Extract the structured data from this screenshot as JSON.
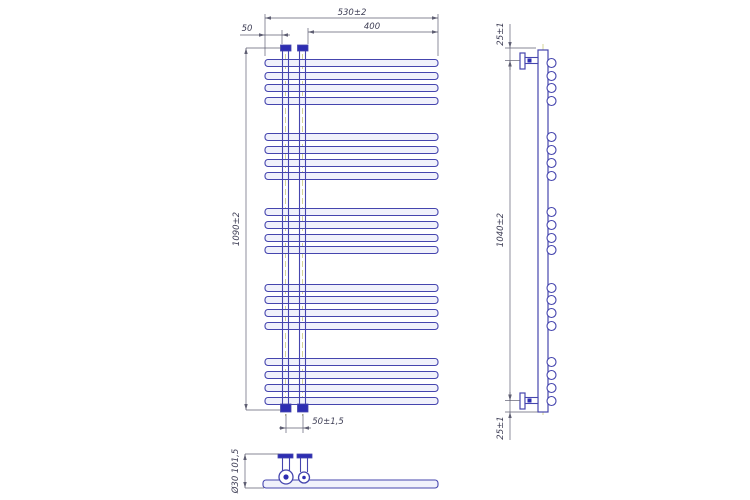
{
  "meta": {
    "description": "CAD three-view technical drawing of a designer towel-rail radiator (front view, side view, bottom view) with dimension callouts",
    "canvas": {
      "w": 750,
      "h": 500
    }
  },
  "colors": {
    "line": "#4545ae",
    "fill_dark": "#2d2db2",
    "tube_fill": "#f0f1fb",
    "white": "#ffffff",
    "centerline": "#c2c26e",
    "dim_line": "#5f5f73",
    "dim_text": "#3e3e55",
    "bg": "#ffffff"
  },
  "front_view": {
    "tube_x1": 265,
    "tube_x2": 438,
    "tube_h": 7,
    "tube_rx": 3,
    "tube_centers_y": [
      63,
      76,
      88,
      101,
      137,
      150,
      163,
      176,
      212,
      225,
      238,
      250,
      288,
      300,
      313,
      326,
      362,
      375,
      388,
      401
    ],
    "riser_lines_x": [
      282.5,
      288.5,
      299.5,
      305.5
    ],
    "riser_centerlines_x": [
      285.5,
      302.5
    ],
    "riser_y1": 51,
    "riser_y2": 404,
    "caps": [
      {
        "x": 280.5,
        "y": 45,
        "w": 10.5,
        "h": 6
      },
      {
        "x": 297.5,
        "y": 45,
        "w": 10.5,
        "h": 6
      }
    ],
    "fittings": [
      {
        "x": 280.5,
        "y": 404,
        "w": 10.5,
        "h": 8
      },
      {
        "x": 297.5,
        "y": 404,
        "w": 10.5,
        "h": 8
      }
    ]
  },
  "side_view": {
    "collector": {
      "x": 538,
      "y": 50,
      "w": 10,
      "h": 362
    },
    "centerline_x": 543,
    "centerline_y1": 44,
    "centerline_y2": 418,
    "circle_cx": 551.5,
    "circle_r": 4.5,
    "circle_centers_y": [
      63,
      76,
      88,
      101,
      137,
      150,
      163,
      176,
      212,
      225,
      238,
      250,
      288,
      300,
      313,
      326,
      362,
      375,
      388,
      401
    ],
    "brackets": [
      {
        "flange": {
          "x": 520,
          "y": 53,
          "w": 5,
          "h": 16
        },
        "arm": {
          "x": 525,
          "y": 57.5,
          "w": 13,
          "h": 6
        },
        "screw": {
          "x": 527.5,
          "y": 58.5,
          "w": 4,
          "h": 4
        }
      },
      {
        "flange": {
          "x": 520,
          "y": 393,
          "w": 5,
          "h": 16
        },
        "arm": {
          "x": 525,
          "y": 397.5,
          "w": 13,
          "h": 6
        },
        "screw": {
          "x": 527.5,
          "y": 398.5,
          "w": 4,
          "h": 4
        }
      }
    ]
  },
  "bottom_view": {
    "tube": {
      "x": 263,
      "y": 480,
      "w": 175,
      "h": 8,
      "rx": 3
    },
    "flanges": [
      {
        "x": 278,
        "y": 454,
        "w": 15,
        "h": 4
      },
      {
        "x": 297,
        "y": 454,
        "w": 15,
        "h": 4
      }
    ],
    "pipes": [
      {
        "x1": 282.5,
        "x2": 289.5,
        "y1": 458,
        "y2": 472
      },
      {
        "x1": 300.5,
        "x2": 307.5,
        "y1": 458,
        "y2": 472
      }
    ],
    "circles": [
      {
        "cx": 286,
        "cy": 477,
        "r": 7,
        "dot": 2.6
      },
      {
        "cx": 304,
        "cy": 477.5,
        "r": 5.5,
        "dot": 1.8
      }
    ]
  },
  "dimensions": [
    {
      "id": "width-total",
      "type": "h",
      "y": 18,
      "x1": 265,
      "x2": 438,
      "label": "530±2",
      "lx": 352,
      "ly": 15,
      "arrows": "in",
      "ext": [
        [
          265,
          14,
          265,
          56
        ],
        [
          438,
          14,
          438,
          56
        ]
      ]
    },
    {
      "id": "width-400",
      "type": "h",
      "y": 32,
      "x1": 308,
      "x2": 438,
      "label": "400",
      "lx": 372,
      "ly": 29,
      "arrows": "in",
      "ext": [
        [
          308,
          28,
          308,
          44
        ]
      ]
    },
    {
      "id": "offset-50",
      "type": "h",
      "y": 35,
      "x1": 265,
      "x2": 282,
      "label": "50",
      "lx": 247,
      "ly": 31,
      "arrows": "out",
      "line": [
        240,
        35,
        290,
        35
      ],
      "ext": [
        [
          282,
          30,
          282,
          44
        ]
      ]
    },
    {
      "id": "height-total",
      "type": "v",
      "x": 246,
      "y1": 48,
      "y2": 410,
      "label": "1090±2",
      "lx": 239,
      "ly": 229,
      "arrows": "in",
      "ext": [
        [
          246,
          48,
          281,
          48
        ],
        [
          246,
          410,
          281,
          410
        ]
      ]
    },
    {
      "id": "conn-spacing",
      "type": "h",
      "y": 428,
      "x1": 286,
      "x2": 303,
      "label": "50±1,5",
      "lx": 328,
      "ly": 424,
      "arrows": "out",
      "line": [
        279,
        428,
        311,
        428
      ],
      "ext": [
        [
          286,
          414,
          286,
          433
        ],
        [
          303,
          414,
          303,
          433
        ]
      ]
    },
    {
      "id": "side-top-offset",
      "type": "v",
      "x": 510,
      "y1": 48,
      "y2": 60.5,
      "label": "25±1",
      "lx": 503,
      "ly": 34,
      "arrows": "out",
      "line": [
        510,
        24,
        510,
        70
      ],
      "ext": [
        [
          505,
          48,
          536,
          48
        ],
        [
          505,
          60.5,
          520,
          60.5
        ]
      ]
    },
    {
      "id": "side-axis-height",
      "type": "v",
      "x": 510,
      "y1": 60.5,
      "y2": 400.5,
      "label": "1040±2",
      "lx": 503,
      "ly": 230,
      "arrows": "in"
    },
    {
      "id": "side-bottom-offset",
      "type": "v",
      "x": 510,
      "y1": 400.5,
      "y2": 412,
      "label": "25±1",
      "lx": 503,
      "ly": 428,
      "arrows": "out",
      "line": [
        510,
        392,
        510,
        440
      ],
      "ext": [
        [
          505,
          400.5,
          520,
          400.5
        ],
        [
          505,
          412,
          538,
          412
        ]
      ]
    },
    {
      "id": "depth",
      "type": "v",
      "x": 245,
      "y1": 454,
      "y2": 488,
      "label": "Ø30 101,5",
      "lx": 238,
      "ly": 471,
      "arrows": "in",
      "ext": [
        [
          245,
          454,
          279,
          454
        ],
        [
          245,
          488,
          264,
          488
        ]
      ]
    }
  ]
}
